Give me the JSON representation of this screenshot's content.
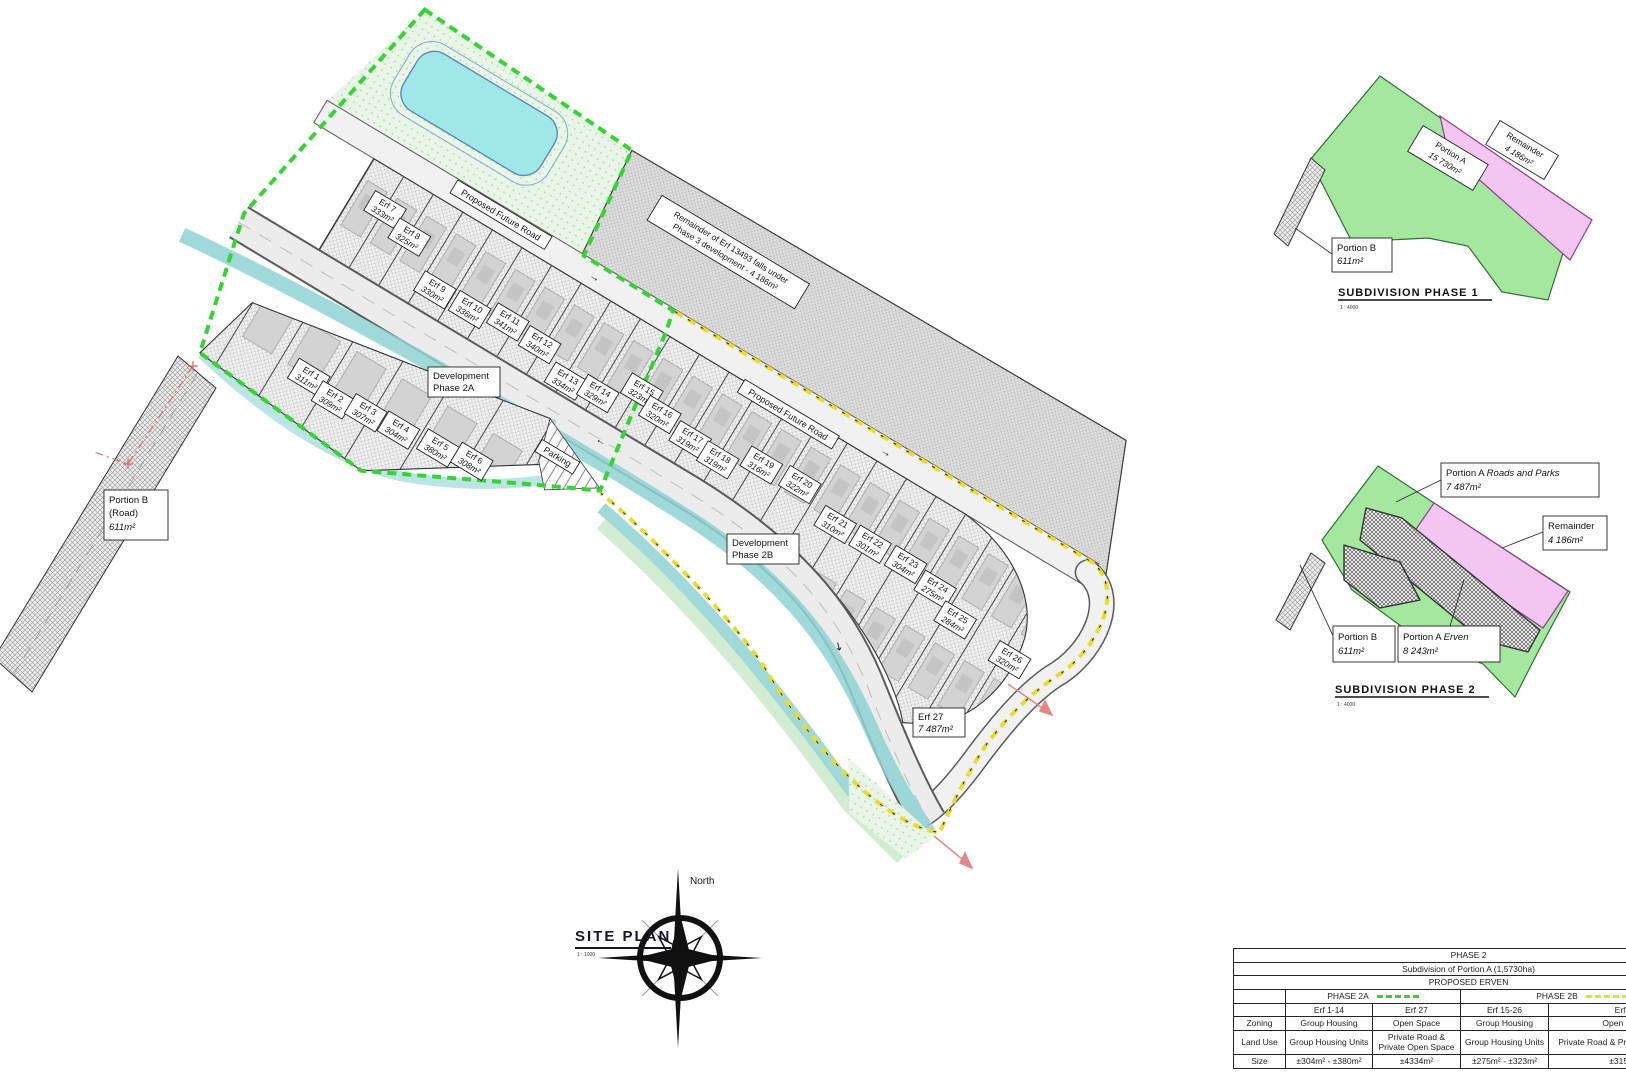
{
  "main_plan": {
    "road_label_1": "Proposed Future Road",
    "road_label_2": "Proposed Future Road",
    "dev2a_line1": "Development",
    "dev2a_line2": "Phase 2A",
    "dev2b_line1": "Development",
    "dev2b_line2": "Phase 2B",
    "parking": "Parking",
    "remainder_note_line1": "Remainder of Erf 13493 falls under",
    "remainder_note_line2": "Phase 3 development - 4 186m²",
    "portion_b_line1": "Portion B",
    "portion_b_line2": "(Road)",
    "portion_b_line3": "611m²",
    "erf27_line1": "Erf 27",
    "erf27_line2": "7 487m²"
  },
  "erven": [
    {
      "name": "Erf 1",
      "area": "311m²"
    },
    {
      "name": "Erf 2",
      "area": "309m²"
    },
    {
      "name": "Erf 3",
      "area": "307m²"
    },
    {
      "name": "Erf 4",
      "area": "304m²"
    },
    {
      "name": "Erf 5",
      "area": "380m²"
    },
    {
      "name": "Erf 6",
      "area": "308m²"
    },
    {
      "name": "Erf 7",
      "area": "333m²"
    },
    {
      "name": "Erf 8",
      "area": "325m²"
    },
    {
      "name": "Erf 9",
      "area": "330m²"
    },
    {
      "name": "Erf 10",
      "area": "336m²"
    },
    {
      "name": "Erf 11",
      "area": "341m²"
    },
    {
      "name": "Erf 12",
      "area": "340m²"
    },
    {
      "name": "Erf 13",
      "area": "334m²"
    },
    {
      "name": "Erf 14",
      "area": "329m²"
    },
    {
      "name": "Erf 15",
      "area": "323m²"
    },
    {
      "name": "Erf 16",
      "area": "320m²"
    },
    {
      "name": "Erf 17",
      "area": "319m²"
    },
    {
      "name": "Erf 18",
      "area": "319m²"
    },
    {
      "name": "Erf 19",
      "area": "316m²"
    },
    {
      "name": "Erf 20",
      "area": "322m²"
    },
    {
      "name": "Erf 21",
      "area": "310m²"
    },
    {
      "name": "Erf 22",
      "area": "301m²"
    },
    {
      "name": "Erf 23",
      "area": "304m²"
    },
    {
      "name": "Erf 24",
      "area": "275m²"
    },
    {
      "name": "Erf 25",
      "area": "284m²"
    },
    {
      "name": "Erf 26",
      "area": "320m²"
    }
  ],
  "site_plan_title": {
    "title": "SITE PLAN",
    "scale": "1 : 1000"
  },
  "north": {
    "label": "North"
  },
  "sub1": {
    "title": "SUBDIVISION PHASE 1",
    "scale": "1 : 4000",
    "portion_a_line1": "Portion A",
    "portion_a_line2": "15 730m²",
    "remainder_line1": "Remainder",
    "remainder_line2": "4 186m²",
    "portion_b_line1": "Portion B",
    "portion_b_line2": "611m²"
  },
  "sub2": {
    "title": "SUBDIVISION PHASE 2",
    "scale": "1 : 4000",
    "roads_parks_prefix": "Portion A ",
    "roads_parks_suffix": "Roads and Parks",
    "roads_parks_area": "7 487m²",
    "remainder_line1": "Remainder",
    "remainder_line2": "4 186m²",
    "portion_b_line1": "Portion B",
    "portion_b_line2": "611m²",
    "erven_prefix": "Portion A ",
    "erven_suffix": "Erven",
    "erven_area": "8 243m²"
  },
  "table": {
    "title": "PHASE 2",
    "subtitle": "Subdivision of Portion A (1,5730ha)",
    "section": "PROPOSED ERVEN",
    "phase_2a": "PHASE 2A",
    "phase_2b": "PHASE 2B",
    "col_headers": [
      "Erf 1-14",
      "Erf 27",
      "Erf 15-26",
      "Erf 27"
    ],
    "rows": [
      {
        "label": "Zoning",
        "cells": [
          "Group Housing",
          "Open Space",
          "Group Housing",
          "Open Space"
        ]
      },
      {
        "label": "Land Use",
        "cells": [
          "Group Housing Units",
          "Private Road & Private Open Space",
          "Group Housing Units",
          "Private Road & Private Open Space"
        ]
      },
      {
        "label": "Size",
        "cells": [
          "±304m² - ±380m²",
          "±4334m²",
          "±275m² - ±323m²",
          "±3153m²"
        ]
      }
    ]
  },
  "colors": {
    "phase2a_boundary": "#33d433",
    "phase2b_boundary": "#e8dc30",
    "stream_teal": "#8ed2d2",
    "pool_cyan": "#a0e8e8",
    "remainder_pink": "#f3c6f1",
    "parcel_green": "#a4e79e",
    "survey_red": "#d66"
  }
}
